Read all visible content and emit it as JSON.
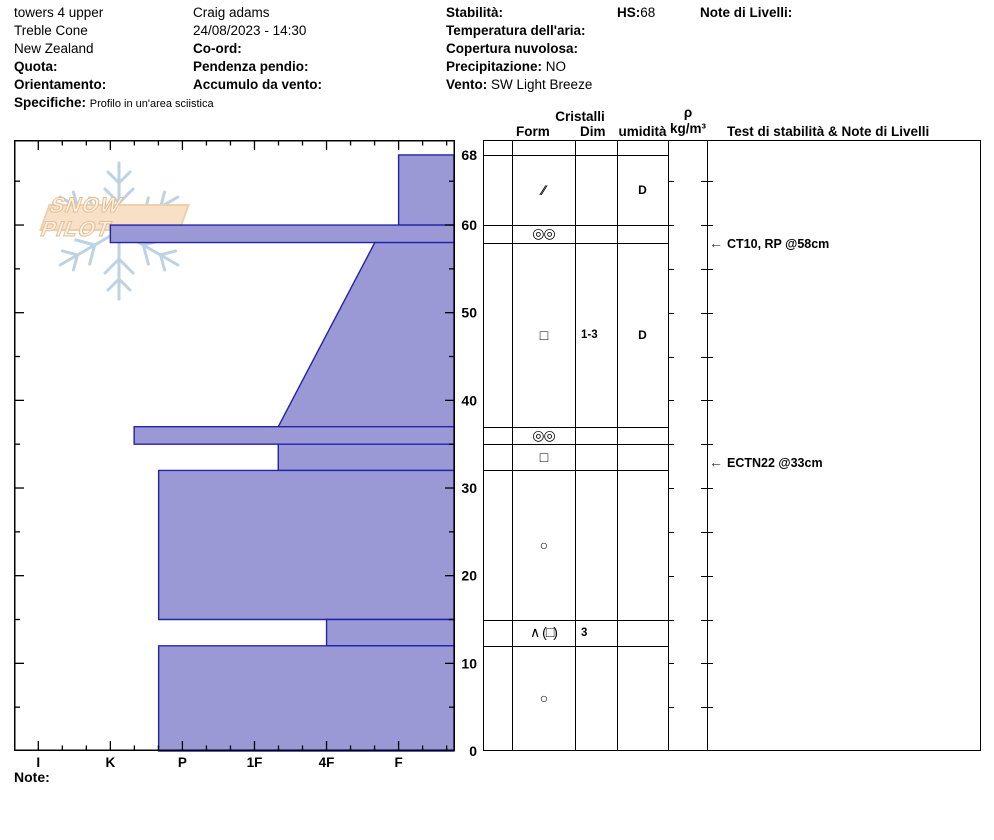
{
  "header": {
    "col1": {
      "pit_name": "towers 4 upper",
      "location": "Treble Cone",
      "country": "New Zealand",
      "quota_label": "Quota:",
      "orientamento_label": "Orientamento:",
      "specifiche_label": "Specifiche:",
      "specifiche_value": "Profilo in un'area sciistica"
    },
    "col2": {
      "observer": "Craig adams",
      "datetime": "24/08/2023 - 14:30",
      "coord_label": "Co-ord:",
      "pendenza_label": "Pendenza pendio:",
      "accumulo_label": "Accumulo da vento:"
    },
    "col3": {
      "stabilita_label": "Stabilità:",
      "temperatura_label": "Temperatura dell'aria:",
      "copertura_label": "Copertura nuvolosa:",
      "precipitazione_label": "Precipitazione:",
      "precipitazione_value": "NO",
      "vento_label": "Vento:",
      "vento_value": "SW Light Breeze"
    },
    "hs_label": "HS:",
    "hs_value": "68",
    "note_livelli_label": "Note di Livelli:"
  },
  "table_headers": {
    "cristalli": "Cristalli",
    "form": "Form",
    "dim": "Dim",
    "umidita": "umidità",
    "rho": "ρ",
    "rho_unit": "kg/m³",
    "test": "Test di stabilità & Note di Livelli"
  },
  "logo": {
    "text": "SNOW PILOT"
  },
  "footer": {
    "note_label": "Note:"
  },
  "colors": {
    "bar_fill": "#9a99d5",
    "bar_stroke": "#2222aa",
    "snowflake": "#bdd2e2",
    "logo_banner": "#f8e0c6"
  },
  "chart_data": {
    "type": "bar",
    "variant": "snow-hardness-profile",
    "title": "Snow pit hand-hardness profile",
    "xlabel": "hand hardness",
    "ylabel": "depth above ground (cm)",
    "hardness_labels": [
      "I",
      "K",
      "P",
      "1F",
      "4F",
      "F"
    ],
    "hardness_values": [
      6,
      5,
      4,
      3,
      2,
      1
    ],
    "depth_ticks": [
      0,
      10,
      20,
      30,
      40,
      50,
      60,
      68
    ],
    "depth_minor_step": 5,
    "ylim": [
      0,
      69.7
    ],
    "total_snow_height_cm": 68,
    "layers": [
      {
        "from_cm": 68,
        "to_cm": 60,
        "hardness_top": 1.0,
        "hardness_bottom": 1.0,
        "hardness_label": "F"
      },
      {
        "from_cm": 60,
        "to_cm": 58,
        "hardness_top": 5.0,
        "hardness_bottom": 5.0,
        "hardness_label": "K"
      },
      {
        "from_cm": 58,
        "to_cm": 37,
        "hardness_top": 1.33,
        "hardness_bottom": 2.67,
        "hardness_label": "F+ to 1F-"
      },
      {
        "from_cm": 37,
        "to_cm": 35,
        "hardness_top": 4.67,
        "hardness_bottom": 4.67,
        "hardness_label": "K-"
      },
      {
        "from_cm": 35,
        "to_cm": 32,
        "hardness_top": 2.67,
        "hardness_bottom": 2.67,
        "hardness_label": "1F-"
      },
      {
        "from_cm": 32,
        "to_cm": 15,
        "hardness_top": 4.33,
        "hardness_bottom": 4.33,
        "hardness_label": "P+"
      },
      {
        "from_cm": 15,
        "to_cm": 12,
        "hardness_top": 2.0,
        "hardness_bottom": 2.0,
        "hardness_label": "4F"
      },
      {
        "from_cm": 12,
        "to_cm": 0,
        "hardness_top": 4.33,
        "hardness_bottom": 4.33,
        "hardness_label": "P+"
      }
    ],
    "grain_rows": [
      {
        "from_cm": 68,
        "to_cm": 60,
        "form": "∕∕",
        "form_name": "decomposing-fragments",
        "dim": "",
        "umidita": "D"
      },
      {
        "from_cm": 60,
        "to_cm": 58,
        "form": "◎◎",
        "form_name": "melt-freeze-crust",
        "dim": "",
        "umidita": ""
      },
      {
        "from_cm": 58,
        "to_cm": 37,
        "form": "□",
        "form_name": "facets",
        "dim": "1-3",
        "umidita": "D"
      },
      {
        "from_cm": 37,
        "to_cm": 35,
        "form": "◎◎",
        "form_name": "melt-freeze-crust",
        "dim": "",
        "umidita": ""
      },
      {
        "from_cm": 35,
        "to_cm": 32,
        "form": "□",
        "form_name": "facets",
        "dim": "",
        "umidita": ""
      },
      {
        "from_cm": 32,
        "to_cm": 15,
        "form": "○",
        "form_name": "rounds",
        "dim": "",
        "umidita": ""
      },
      {
        "from_cm": 15,
        "to_cm": 12,
        "form": "∧ (□)",
        "form_name": "depth-hoar-facets",
        "dim": "3",
        "umidita": ""
      },
      {
        "from_cm": 12,
        "to_cm": 0,
        "form": "○",
        "form_name": "rounds",
        "dim": "",
        "umidita": ""
      }
    ],
    "stability_tests": [
      {
        "label": "CT10, RP @58cm",
        "depth_cm": 58
      },
      {
        "label": "ECTN22 @33cm",
        "depth_cm": 33
      }
    ]
  }
}
